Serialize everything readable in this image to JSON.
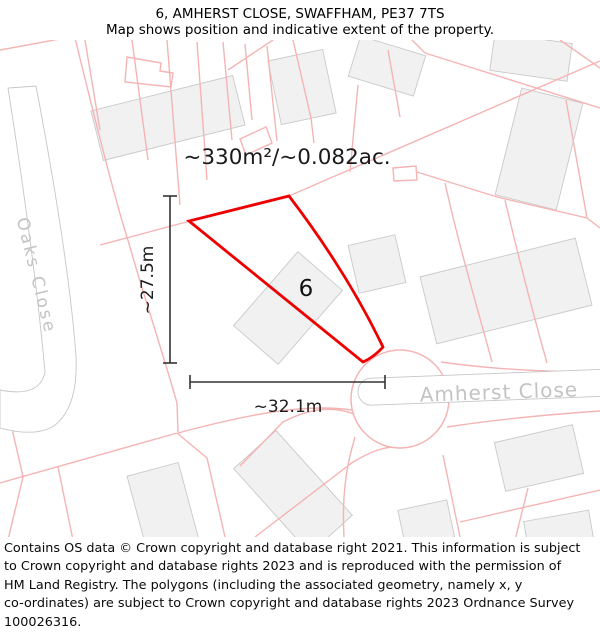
{
  "header": {
    "title": "6, AMHERST CLOSE, SWAFFHAM, PE37 7TS",
    "subtitle": "Map shows position and indicative extent of the property."
  },
  "map": {
    "area_label": "~330m²/~0.082ac.",
    "plot_number": "6",
    "width_label": "~32.1m",
    "height_label": "~27.5m",
    "street_labels": {
      "left": "Oaks Close",
      "right": "Amherst Close"
    },
    "colors": {
      "plot_outline_red": "#ee0000",
      "parcel_line_pink": "#f5b4b4",
      "building_fill": "#f1f1f1",
      "building_stroke": "#c9c9c9",
      "road_casing_gray": "#c6c6c6",
      "street_label_gray": "#c3c3c3",
      "dimension_line": "#333333"
    }
  },
  "footer": {
    "copyright": "Contains OS data © Crown copyright and database right 2021. This information is subject\nto Crown copyright and database rights 2023 and is reproduced with the permission of\nHM Land Registry. The polygons (including the associated geometry, namely x, y\nco-ordinates) are subject to Crown copyright and database rights 2023 Ordnance Survey\n100026316."
  }
}
